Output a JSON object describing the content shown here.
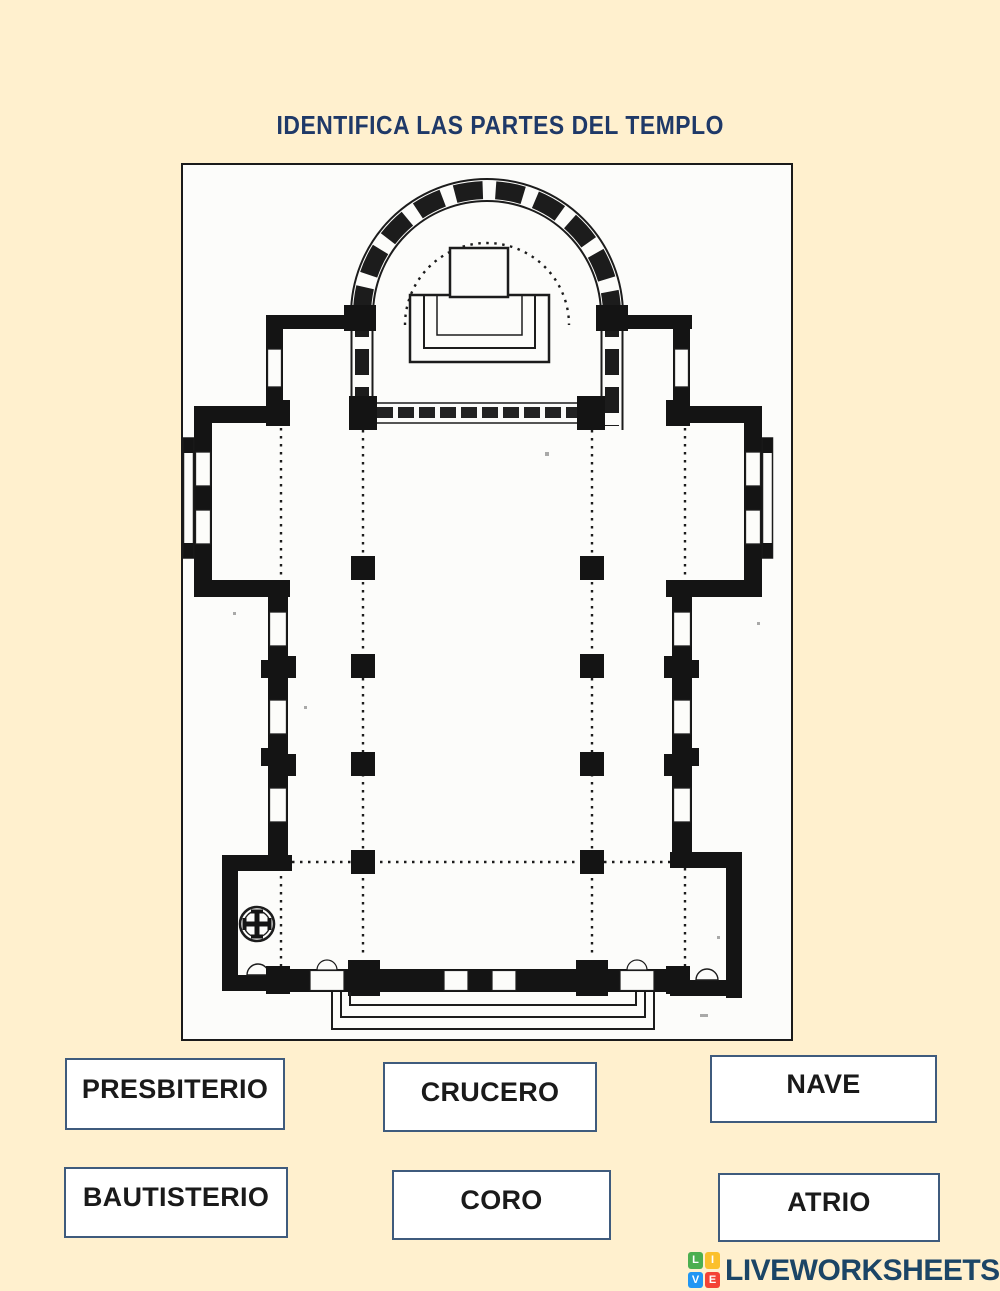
{
  "page": {
    "background_color": "#FFF0CE",
    "title": "IDENTIFICA LAS PARTES DEL TEMPLO",
    "title_color": "#1F3968"
  },
  "floorplan": {
    "kind": "church-floor-plan-drawing",
    "paper_color": "#FCFCFA",
    "ink_color": "#1C1C1C",
    "frame_color": "#1A1A1A",
    "symbol": "cross-pattee-in-circle-baptismal-font"
  },
  "answer_boxes": [
    {
      "id": "presbiterio",
      "label": "PRESBITERIO"
    },
    {
      "id": "crucero",
      "label": "CRUCERO"
    },
    {
      "id": "nave",
      "label": "NAVE"
    },
    {
      "id": "bautisterio",
      "label": "BAUTISTERIO"
    },
    {
      "id": "coro",
      "label": "CORO"
    },
    {
      "id": "atrio",
      "label": "ATRIO"
    }
  ],
  "box_style": {
    "border_color": "#3F5B7D",
    "fill_color": "#FFFFFF",
    "text_color": "#1A1A1A"
  },
  "branding": {
    "text": "LIVEWORKSHEETS",
    "text_color": "#1B4566",
    "tiles": [
      {
        "letter": "L",
        "color": "#4CAF50"
      },
      {
        "letter": "I",
        "color": "#FBC02D"
      },
      {
        "letter": "V",
        "color": "#2196F3"
      },
      {
        "letter": "E",
        "color": "#F44336"
      }
    ]
  }
}
